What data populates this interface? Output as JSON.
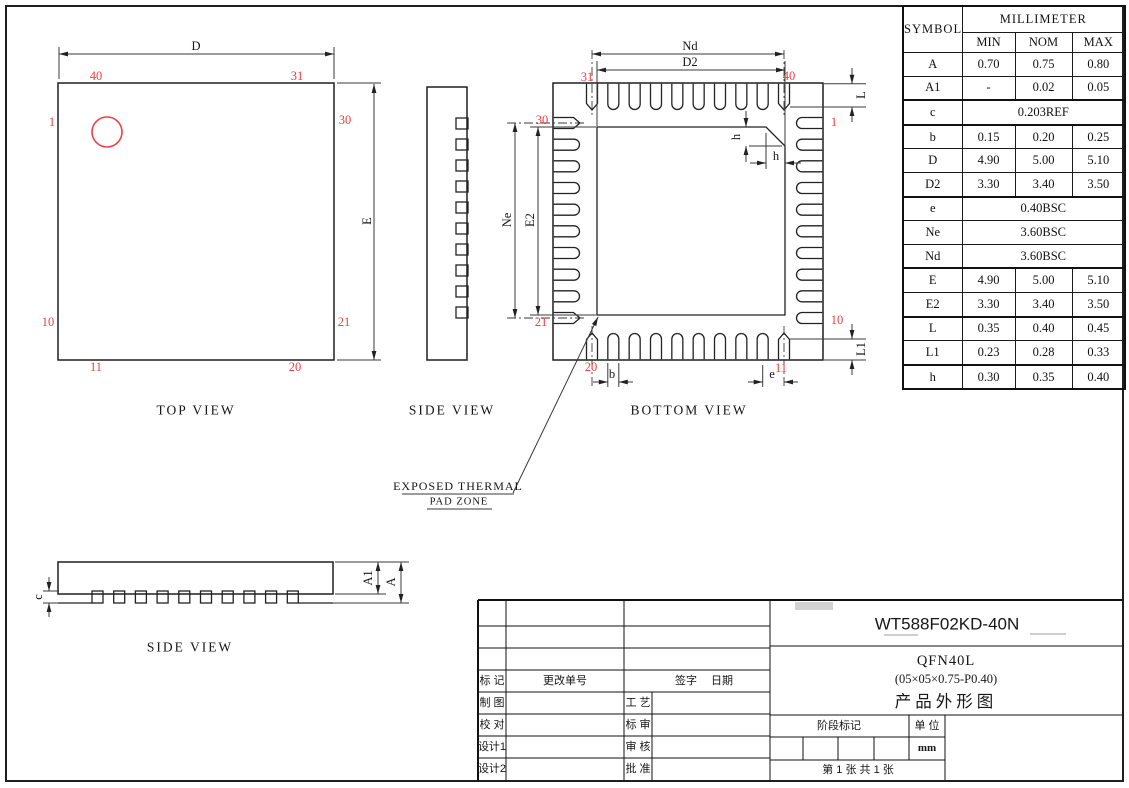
{
  "drawing": {
    "top_view": {
      "caption": "TOP VIEW",
      "dim_d": "D",
      "dim_e": "E",
      "pins": {
        "top_left": "40",
        "top_right": "31",
        "left_top": "1",
        "right_top": "30",
        "left_bottom": "10",
        "right_bottom": "21",
        "bottom_left": "11",
        "bottom_right": "20"
      }
    },
    "side_view_top": {
      "caption": "SIDE VIEW"
    },
    "bottom_view": {
      "caption": "BOTTOM VIEW",
      "dim_nd": "Nd",
      "dim_d2": "D2",
      "dim_ne": "Ne",
      "dim_e2": "E2",
      "dim_l": "L",
      "dim_l1": "L1",
      "dim_h_vertical": "h",
      "dim_h_horizontal": "h",
      "dim_b": "b",
      "dim_e": "e",
      "pins": {
        "top_left": "31",
        "top_right": "40",
        "left_top": "30",
        "left_bottom": "21",
        "right_top": "1",
        "right_bottom": "10",
        "bottom_left": "20",
        "bottom_right": "11"
      }
    },
    "side_view_bottom": {
      "caption": "SIDE VIEW",
      "dim_c": "c",
      "dim_a1": "A1",
      "dim_a": "A"
    },
    "thermal_pad_note": {
      "line1": "EXPOSED THERMAL",
      "line2": "PAD ZONE"
    }
  },
  "dim_table": {
    "header": {
      "symbol": "SYMBOL",
      "unit_group": "MILLIMETER",
      "min": "MIN",
      "nom": "NOM",
      "max": "MAX"
    },
    "rows": [
      {
        "symbol": "A",
        "min": "0.70",
        "nom": "0.75",
        "max": "0.80"
      },
      {
        "symbol": "A1",
        "min": "-",
        "nom": "0.02",
        "max": "0.05"
      },
      {
        "symbol": "c",
        "span": "0.203REF"
      },
      {
        "symbol": "b",
        "min": "0.15",
        "nom": "0.20",
        "max": "0.25"
      },
      {
        "symbol": "D",
        "min": "4.90",
        "nom": "5.00",
        "max": "5.10"
      },
      {
        "symbol": "D2",
        "min": "3.30",
        "nom": "3.40",
        "max": "3.50"
      },
      {
        "symbol": "e",
        "span": "0.40BSC"
      },
      {
        "symbol": "Ne",
        "span": "3.60BSC"
      },
      {
        "symbol": "Nd",
        "span": "3.60BSC"
      },
      {
        "symbol": "E",
        "min": "4.90",
        "nom": "5.00",
        "max": "5.10"
      },
      {
        "symbol": "E2",
        "min": "3.30",
        "nom": "3.40",
        "max": "3.50"
      },
      {
        "symbol": "L",
        "min": "0.35",
        "nom": "0.40",
        "max": "0.45"
      },
      {
        "symbol": "L1",
        "min": "0.23",
        "nom": "0.28",
        "max": "0.33"
      },
      {
        "symbol": "h",
        "min": "0.30",
        "nom": "0.35",
        "max": "0.40"
      }
    ]
  },
  "title_block": {
    "product_code": "WT588F02KD-40N",
    "package_type": "QFN40L",
    "package_size": "(05×05×0.75-P0.40)",
    "doc_type": "产品外形图",
    "mark_label": "标 记",
    "change_order_label": "更改单号",
    "sign_label": "签字",
    "date_label": "日期",
    "draft_label": "制 图",
    "craft_label": "工 艺",
    "proofread_label": "校 对",
    "standard_review_label": "标 审",
    "design1_label": "设计1",
    "review_label": "审 核",
    "design2_label": "设计2",
    "approve_label": "批 准",
    "stage_mark_label": "阶段标记",
    "unit_label": "单 位",
    "unit_value": "mm",
    "sheet_info": "第 1 张    共 1 张"
  }
}
